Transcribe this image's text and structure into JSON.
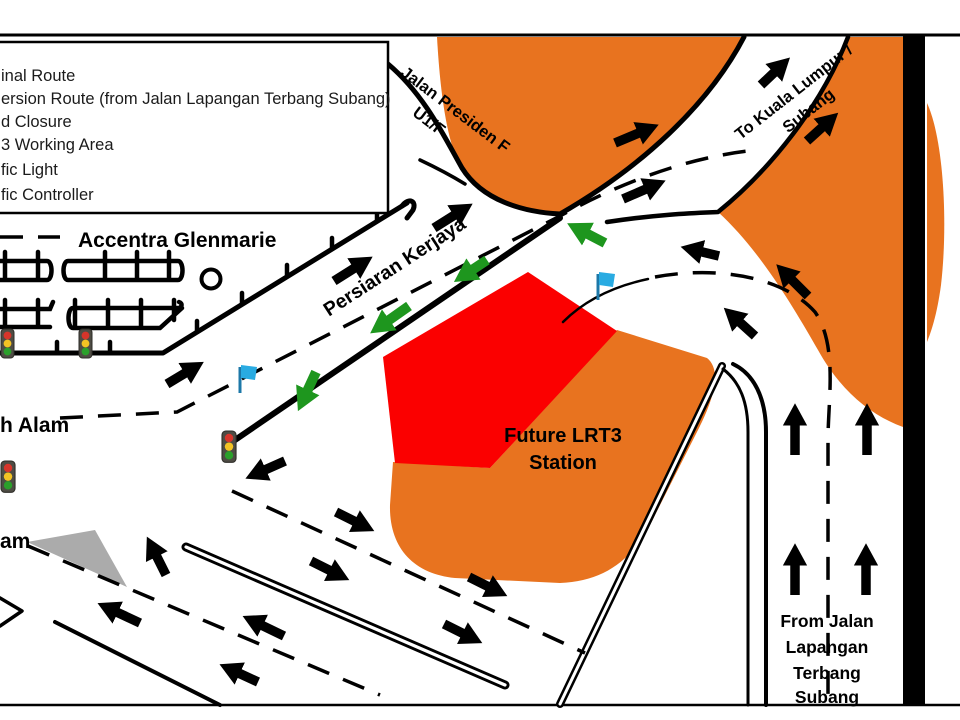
{
  "title": "LRT3 traffic diversion plan map",
  "colors": {
    "working_area_orange": "#E8731F",
    "road_closure_red": "#FB0000",
    "diversion_green": "#1E961E",
    "traffic_controller_blue": "#29ABE2",
    "island_gray": "#ABABAB",
    "route_black": "#000000",
    "background": "#FFFFFF"
  },
  "legend": {
    "items": [
      "inal Route",
      "ersion Route (from Jalan Lapangan Terbang Subang)",
      "d Closure",
      "3 Working Area",
      "fic Light",
      "fic Controller"
    ]
  },
  "labels": {
    "jalan_presiden_line1": "Jalan Presiden F",
    "jalan_presiden_line2": "U1/F",
    "to_kl_line1": "To Kuala Lumpur /",
    "to_kl_line2": "Subang",
    "persiaran": "Persiaran Kerjaya",
    "accentra": "Accentra Glenmarie",
    "station_line1": "Future LRT3",
    "station_line2": "Station",
    "from_jalan_line1": "From Jalan",
    "from_jalan_line2": "Lapangan",
    "from_jalan_line3": "Terbang",
    "from_jalan_line4": "Subang",
    "shah_alam_partial_upper": "h Alam",
    "shah_alam_partial_lower": "am"
  },
  "icons": {
    "traffic_light": "traffic-light-icon",
    "controller_flag": "flag-icon"
  }
}
